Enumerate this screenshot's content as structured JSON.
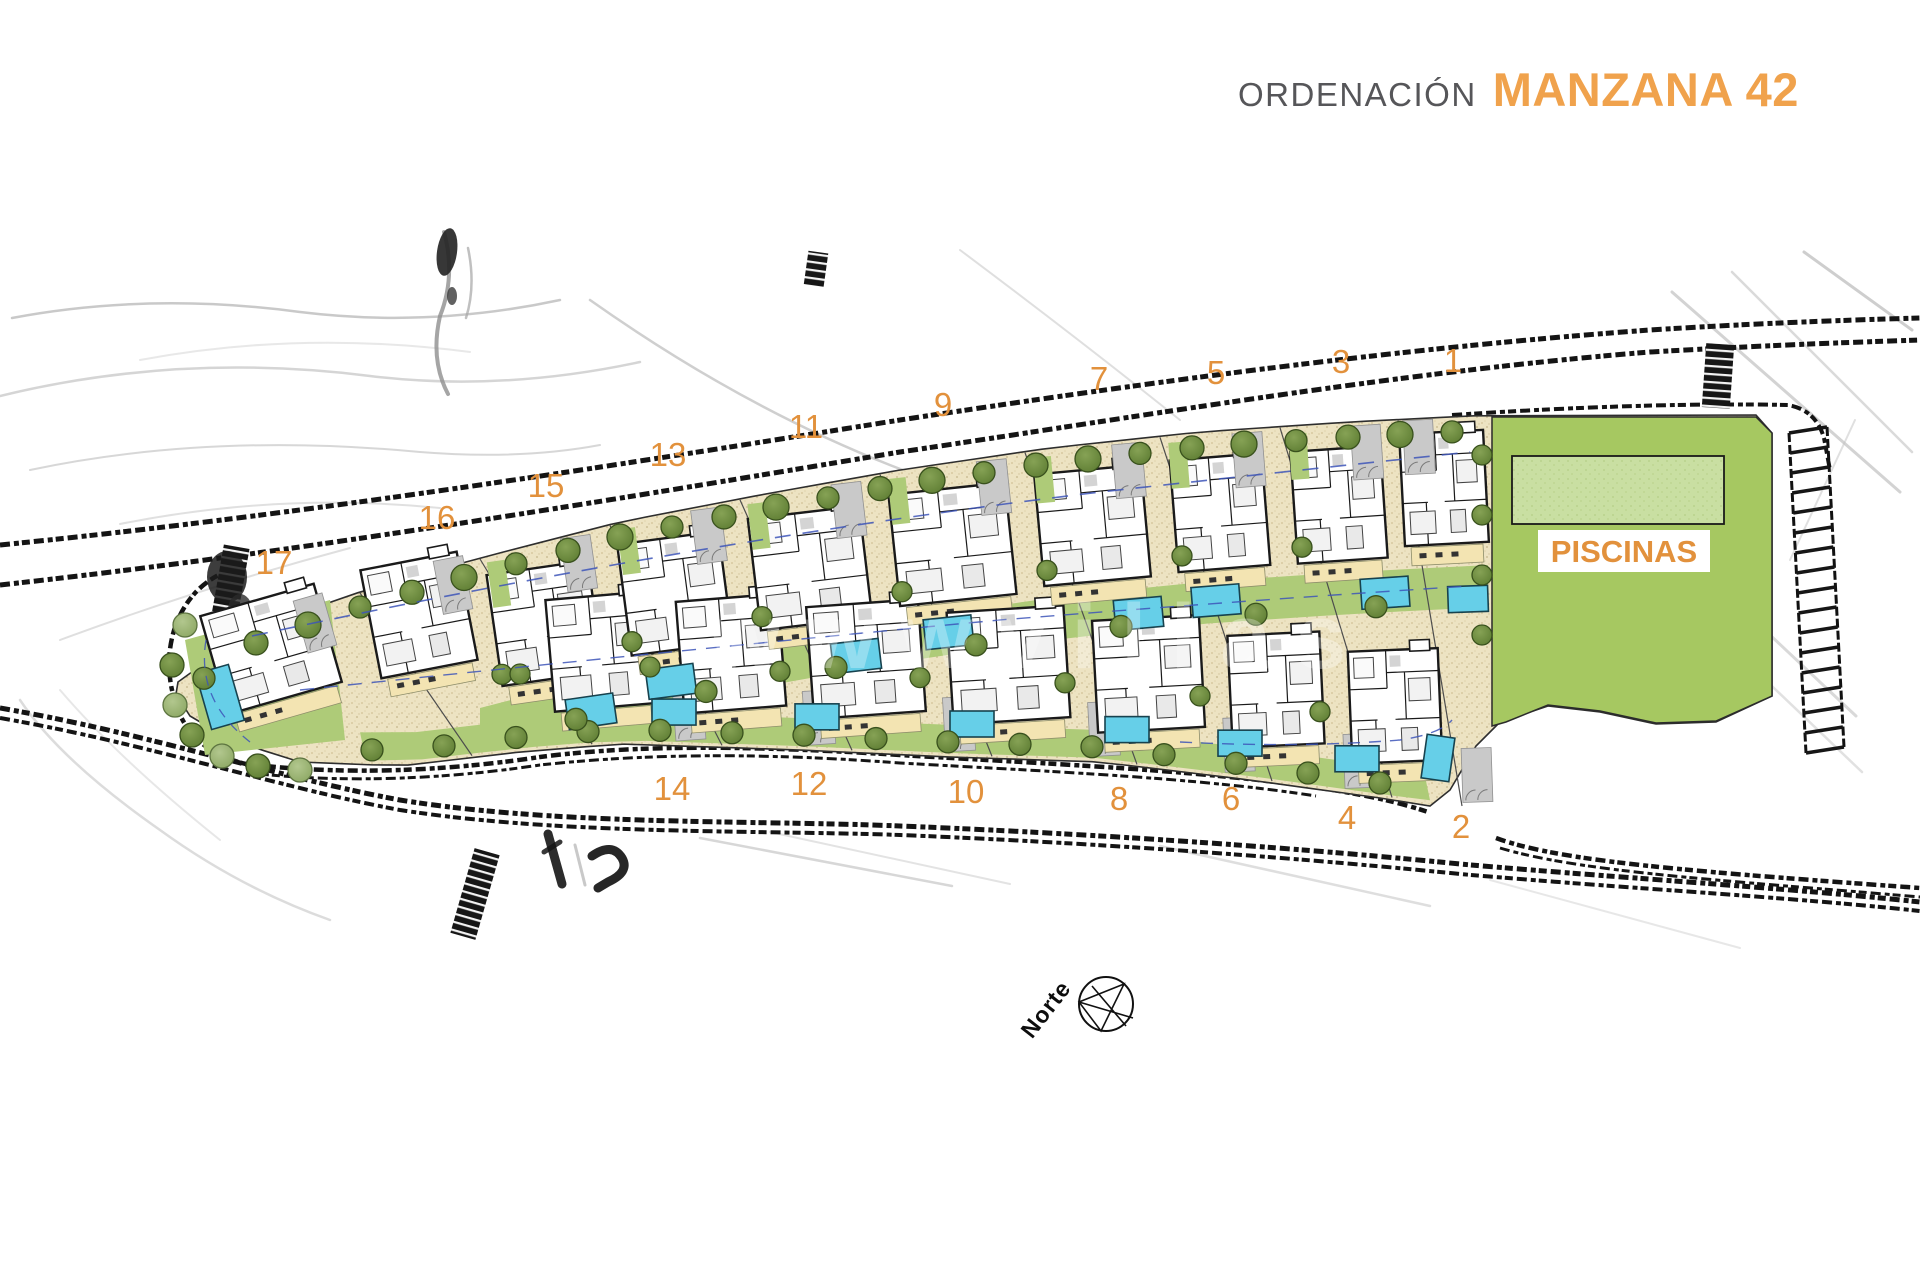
{
  "title": {
    "section": "ORDENACIÓN",
    "name": "MANZANA 42"
  },
  "plan": {
    "piscinas_label": "PISCINAS",
    "north_label": "Norte",
    "watermark": "wwwvillas",
    "plots": [
      {
        "n": "17",
        "x": 274,
        "y": 563
      },
      {
        "n": "16",
        "x": 437,
        "y": 518
      },
      {
        "n": "15",
        "x": 546,
        "y": 486
      },
      {
        "n": "13",
        "x": 668,
        "y": 455
      },
      {
        "n": "11",
        "x": 806,
        "y": 427
      },
      {
        "n": "9",
        "x": 943,
        "y": 405
      },
      {
        "n": "7",
        "x": 1099,
        "y": 379
      },
      {
        "n": "5",
        "x": 1216,
        "y": 373
      },
      {
        "n": "3",
        "x": 1341,
        "y": 362
      },
      {
        "n": "1",
        "x": 1453,
        "y": 361
      },
      {
        "n": "14",
        "x": 672,
        "y": 789
      },
      {
        "n": "12",
        "x": 809,
        "y": 784
      },
      {
        "n": "10",
        "x": 966,
        "y": 792
      },
      {
        "n": "8",
        "x": 1119,
        "y": 799
      },
      {
        "n": "6",
        "x": 1231,
        "y": 799
      },
      {
        "n": "4",
        "x": 1347,
        "y": 818
      },
      {
        "n": "2",
        "x": 1461,
        "y": 827
      }
    ]
  },
  "colors": {
    "accent_orange": "#E2913C",
    "title_orange": "#F0A24C",
    "title_gray": "#565659",
    "sand": "#EDE3C2",
    "lawn": "#AECB78",
    "piscinas_green": "#A6C861",
    "pool_blue": "#66CFE8",
    "pool_pale_green": "#C9DFA2",
    "terrace": "#F3E4B2",
    "driveway": "#C9C9C9",
    "tree_dark": "#6E8C3F",
    "tree_light": "#9CB374",
    "wall": "#1A1A1A",
    "watermark_white": "#FFFFFF"
  }
}
